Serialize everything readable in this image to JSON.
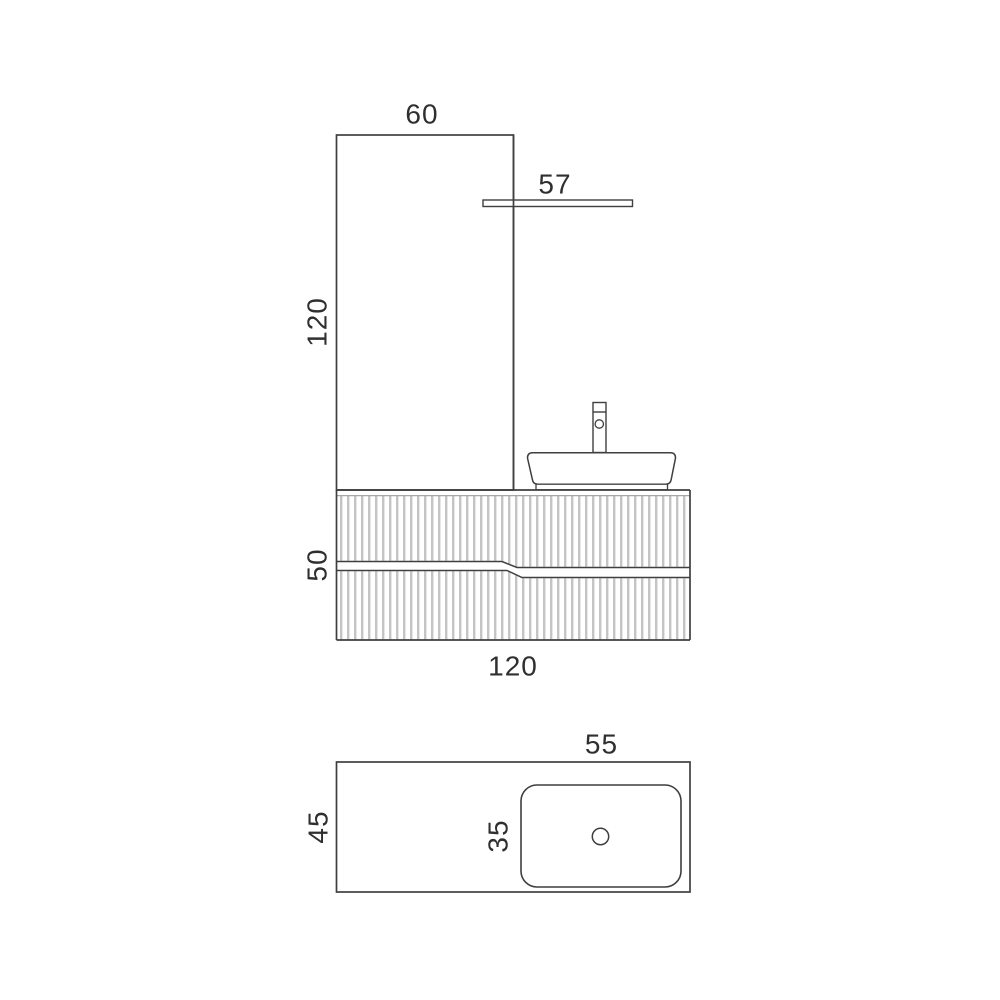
{
  "diagram": {
    "title": "vanity-unit-technical-drawing",
    "front_view": {
      "panel_width_label": "60",
      "panel_height_label": "120",
      "shelf_length_label": "57",
      "cabinet_height_label": "50",
      "cabinet_width_label": "120"
    },
    "plan_view": {
      "basin_width_label": "55",
      "unit_depth_label": "45",
      "basin_depth_label": "35"
    },
    "colors": {
      "line": "#3f3f3f",
      "flute": "#c4c4c4",
      "flute_top_line": "#a6a6a6",
      "text": "#2f2f2f",
      "background": "#ffffff"
    }
  }
}
